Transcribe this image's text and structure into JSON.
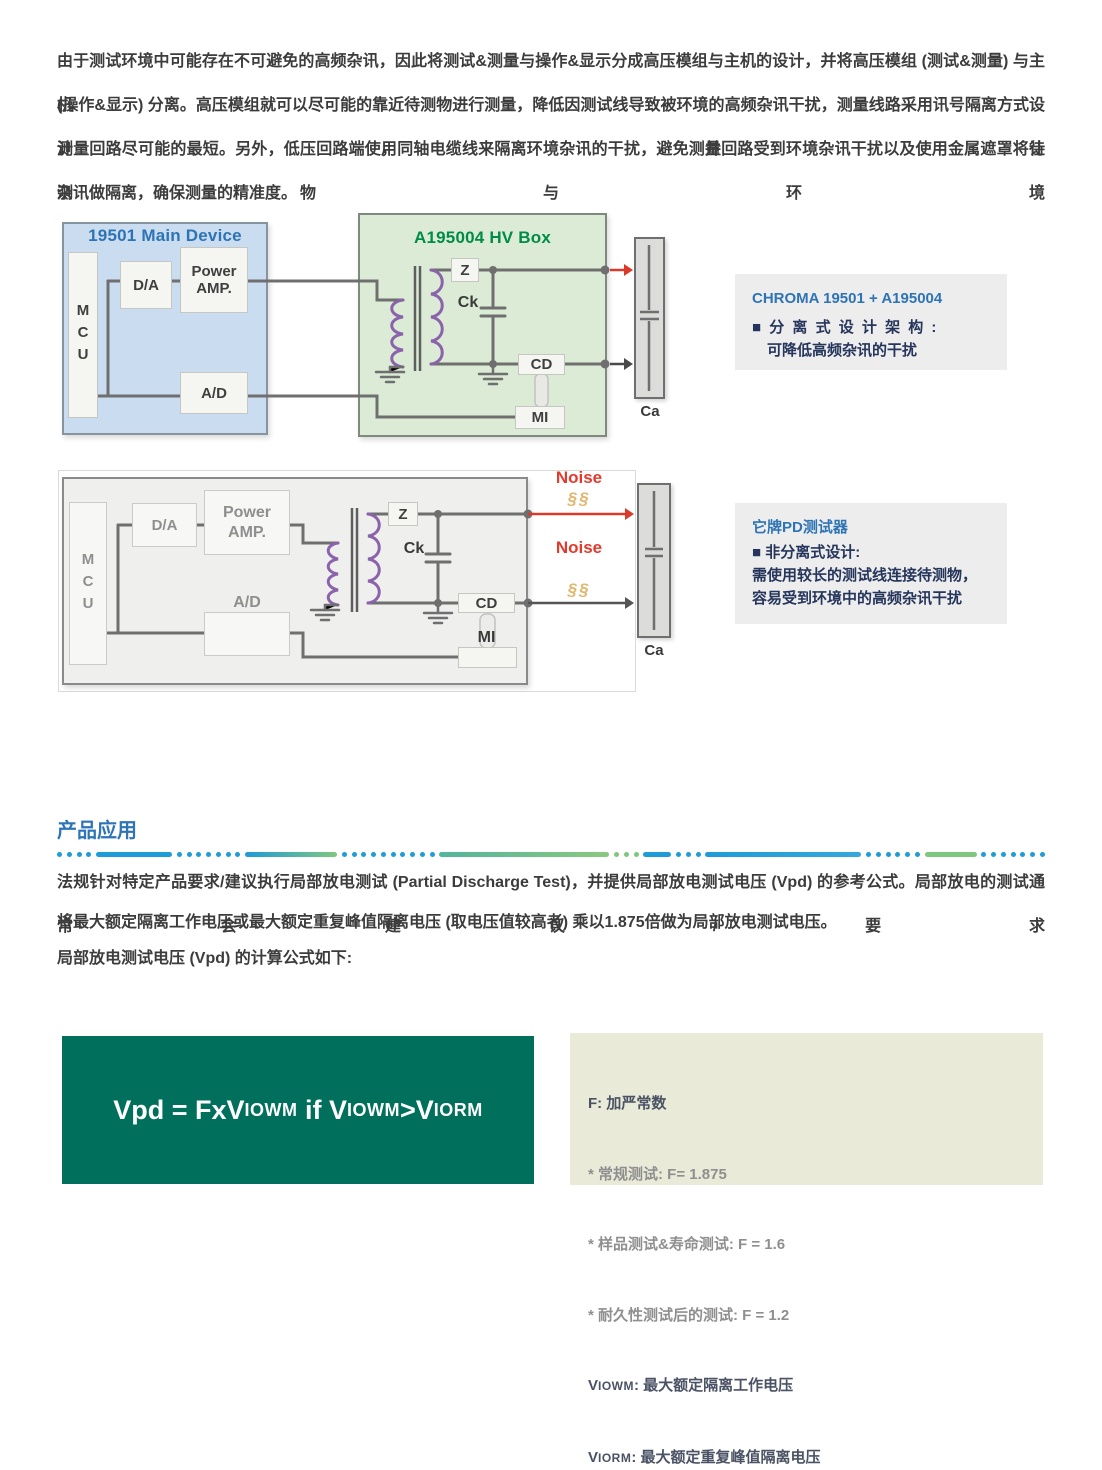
{
  "colors": {
    "accent_blue": "#2E75B6",
    "title_blue": "#2E74B5",
    "title_green": "#008C48",
    "formula_green": "#00705C",
    "noise_red": "#E23B2E",
    "noise_gold": "#E2B56B",
    "coil_purple": "#8A63AC"
  },
  "intro": {
    "lines": [
      "由于测试环境中可能存在不可避免的高频杂讯，因此将测试&测量与操作&显示分成高压模组与主机的设计，并将高压模组 (测试&测量) 与主机",
      "(操作&显示) 分离。高压模组就可以尽可能的靠近待测物进行测量，降低因测试线导致被环境的高频杂讯干扰，测量线路采用讯号隔离方式设计，并让",
      "测量回路尽可能的最短。另外，低压回路端使用同轴电缆线来隔离环境杂讯的干扰，避免测量回路受到环境杂讯干扰以及使用金属遮罩将待测物与环境",
      "杂讯做隔离，确保测量的精准度。"
    ]
  },
  "figure1": {
    "main_device_title": "19501 Main Device",
    "hv_box_title": "A195004 HV Box",
    "mcu": "MCU",
    "da": "D/A",
    "power_line1": "Power",
    "power_line2": "AMP.",
    "ad": "A/D",
    "z": "Z",
    "ck": "Ck",
    "cd": "CD",
    "mi": "MI",
    "ca": "Ca"
  },
  "note1": {
    "title": "CHROMA 19501 + A195004",
    "line1": "■ 分 离 式 设 计 架 构 :",
    "line2": "可降低高频杂讯的干扰"
  },
  "figure2": {
    "mcu": "MCU",
    "da": "D/A",
    "power_line1": "Power",
    "power_line2": "AMP.",
    "ad": "A/D",
    "z": "Z",
    "ck": "Ck",
    "cd": "CD",
    "mi": "MI",
    "ca": "Ca",
    "noise_top": "Noise",
    "noise_bottom": "Noise",
    "noise_symbol_top": "§§",
    "noise_symbol_bottom": "§§"
  },
  "note2": {
    "title": "它牌PD测试器",
    "line1": "■ 非分离式设计:",
    "line2": "需使用较长的测试线连接待测物，",
    "line3": "容易受到环境中的高频杂讯干扰"
  },
  "section": {
    "title": "产品应用"
  },
  "application": {
    "lines": [
      "法规针对特定产品要求/建议执行局部放电测试 (Partial Discharge Test)，并提供局部放电测试电压 (Vpd) 的参考公式。局部放电的测试通常会建议/要求",
      "将最大额定隔离工作电压或最大额定重复峰值隔离电压 (取电压值较高者) 乘以1.875倍做为局部放电测试电压。",
      "局部放电测试电压 (Vpd) 的计算公式如下:"
    ]
  },
  "formula": {
    "p1": "Vpd = FxV",
    "s1": "IOWM",
    "p2": " if V",
    "s2": "IOWM",
    "p3": ">V",
    "s3": "IORM"
  },
  "formula_notes": {
    "f_line": "F: 加严常数",
    "item1": "* 常规测试: F= 1.875",
    "item2": "* 样品测试&寿命测试: F = 1.6",
    "item3": "* 耐久性测试后的测试: F = 1.2",
    "viowm_prefix": "V",
    "viowm_sub": "IOWM",
    "viowm_text": ": 最大额定隔离工作电压",
    "viorm_prefix": "V",
    "viorm_sub": "IORM",
    "viorm_text": ": 最大额定重复峰值隔离电压"
  }
}
